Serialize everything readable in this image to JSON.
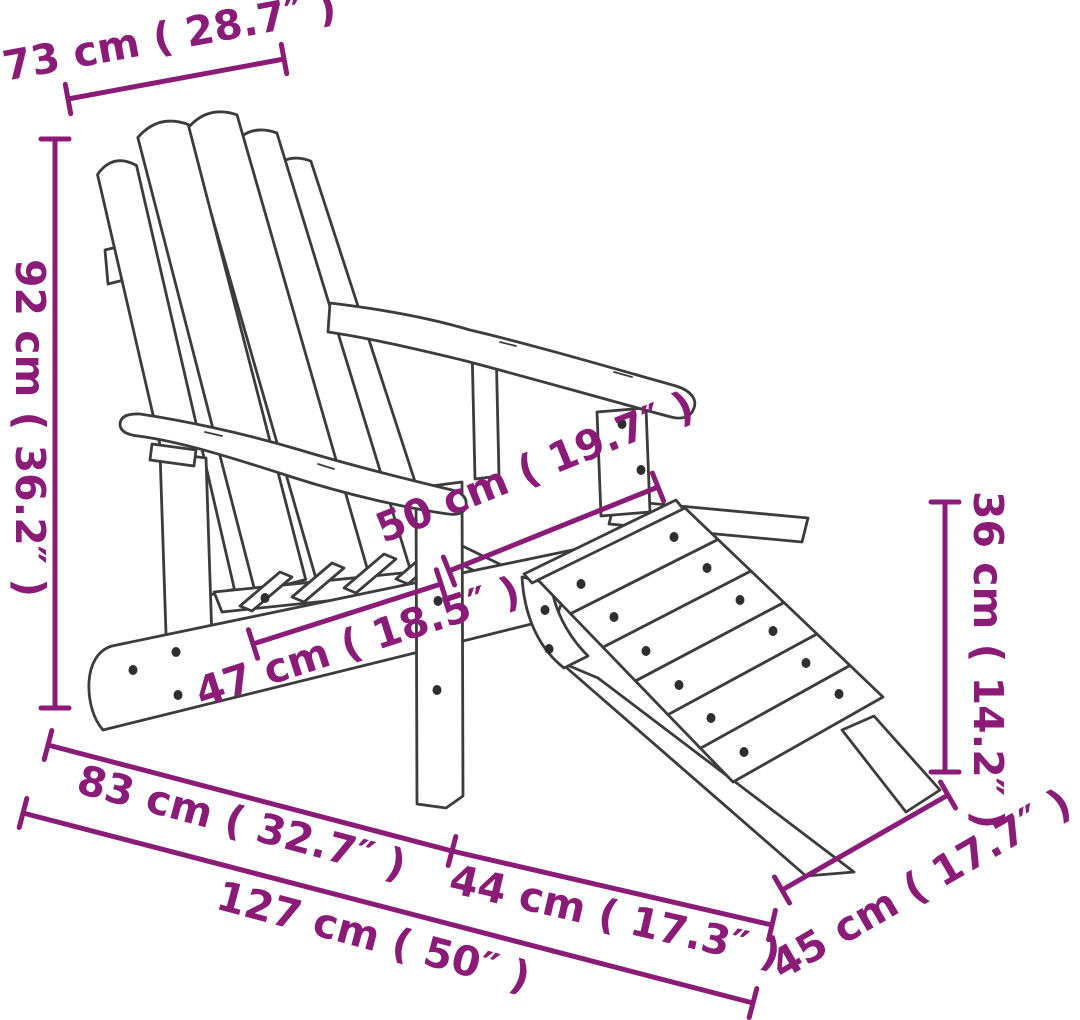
{
  "diagram": {
    "subject": "adirondack-chair-with-footstool-dimension-diagram",
    "background_color": "#ffffff",
    "drawing_line_color": "#3c3c3c",
    "accent_color": "#8a1b77",
    "dimensions": [
      {
        "id": "backrest-width",
        "label": "73 cm ( 28.7″ )"
      },
      {
        "id": "chair-height",
        "label": "92 cm ( 36.2″ )"
      },
      {
        "id": "seat-depth",
        "label": "50 cm ( 19.7″ )"
      },
      {
        "id": "seat-width",
        "label": "47 cm ( 18.5″ )"
      },
      {
        "id": "stool-height",
        "label": "36 cm ( 14.2″ )"
      },
      {
        "id": "chair-depth",
        "label": "83 cm ( 32.7″ )"
      },
      {
        "id": "stool-depth",
        "label": "44 cm ( 17.3″ )"
      },
      {
        "id": "total-depth",
        "label": "127 cm ( 50″ )"
      },
      {
        "id": "stool-width",
        "label": "45 cm ( 17.7″ )"
      }
    ]
  }
}
